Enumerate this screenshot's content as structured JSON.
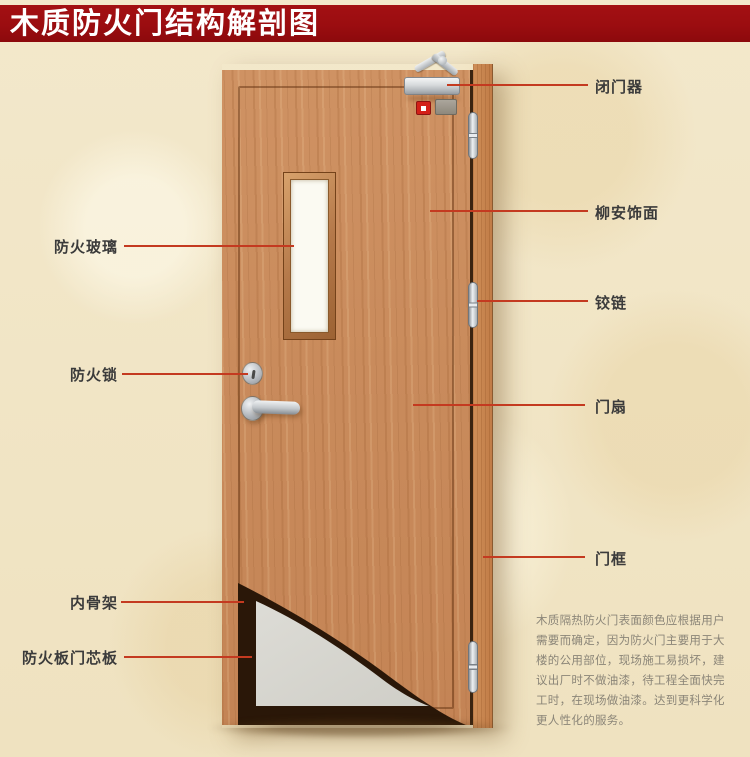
{
  "title": "木质防火门结构解剖图",
  "callouts": {
    "left": [
      {
        "label": "防火玻璃"
      },
      {
        "label": "防火锁"
      },
      {
        "label": "内骨架"
      },
      {
        "label": "防火板门芯板"
      }
    ],
    "right": [
      {
        "label": "闭门器"
      },
      {
        "label": "柳安饰面"
      },
      {
        "label": "铰链"
      },
      {
        "label": "门扇"
      },
      {
        "label": "门框"
      }
    ]
  },
  "description": {
    "text": "木质隔热防火门表面颜色应根据用户\n需要而确定，因为防火门主要用于大\n楼的公用部位，现场施工易损坏，建\n议出厂时不做油漆，待工程全面快完\n工时，在现场做油漆。达到更科学化\n更人性化的服务。"
  },
  "colors": {
    "banner": "#9b0d10",
    "banner_text": "#ffffff",
    "callout_line": "#c43a20",
    "label_text": "#3b3b3b",
    "description_text": "#8b8578",
    "door_wood": "#c98b5c",
    "frame_wood": "#c17c47",
    "inner_skeleton": "#2a1708",
    "core_board": "#d7d6d0",
    "background": "#f1e5c6"
  }
}
